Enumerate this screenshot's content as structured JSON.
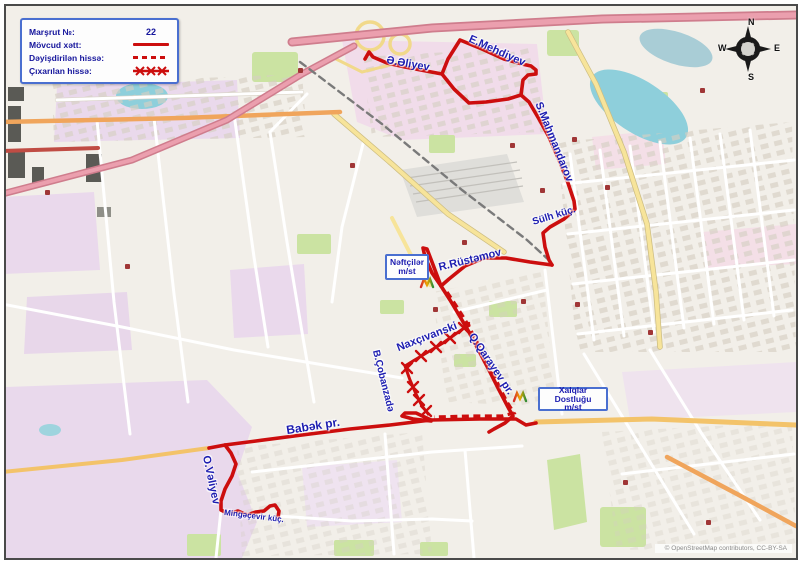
{
  "legend": {
    "route_label": "Marşrut №:",
    "route_number": "22",
    "existing_label": "Mövcud xətt:",
    "changed_label": "Dəyişdirilən hissə:",
    "removed_label": "Çıxarılan hissə:"
  },
  "streets": {
    "aliyev": "Ə.Əliyev",
    "mehdiyev": "E.Mehdiyev",
    "mahmandarov": "S.Mahmandarov",
    "sulh": "Sülh küç.",
    "rustamov": "R.Rüstəmov",
    "naxcivanski": "Naxçıvanski",
    "cobanzade": "B.Çobanzadə",
    "qarayev": "Q.Qarayev pr.",
    "babek": "Babək pr.",
    "valiyev": "O.Vəliyev",
    "mingacevir": "Mingəçevir küç."
  },
  "stations": {
    "neftciler_line1": "Nəftçilər",
    "neftciler_line2": "m/st",
    "xalqlar_line1": "Xalqlar Dostluğu",
    "xalqlar_line2": "m/st"
  },
  "compass": {
    "n": "N",
    "e": "E",
    "s": "S",
    "w": "W"
  },
  "attribution": "© OpenStreetMap contributors, CC-BY-SA",
  "colors": {
    "route_red": "#cc0e0e",
    "label_blue": "#1d1db0",
    "legend_text": "#15159c",
    "box_border": "#4a6fd0",
    "water": "#8ecfdb",
    "park_green": "#cbe3a2",
    "residential_pink": "#ead9ec"
  }
}
